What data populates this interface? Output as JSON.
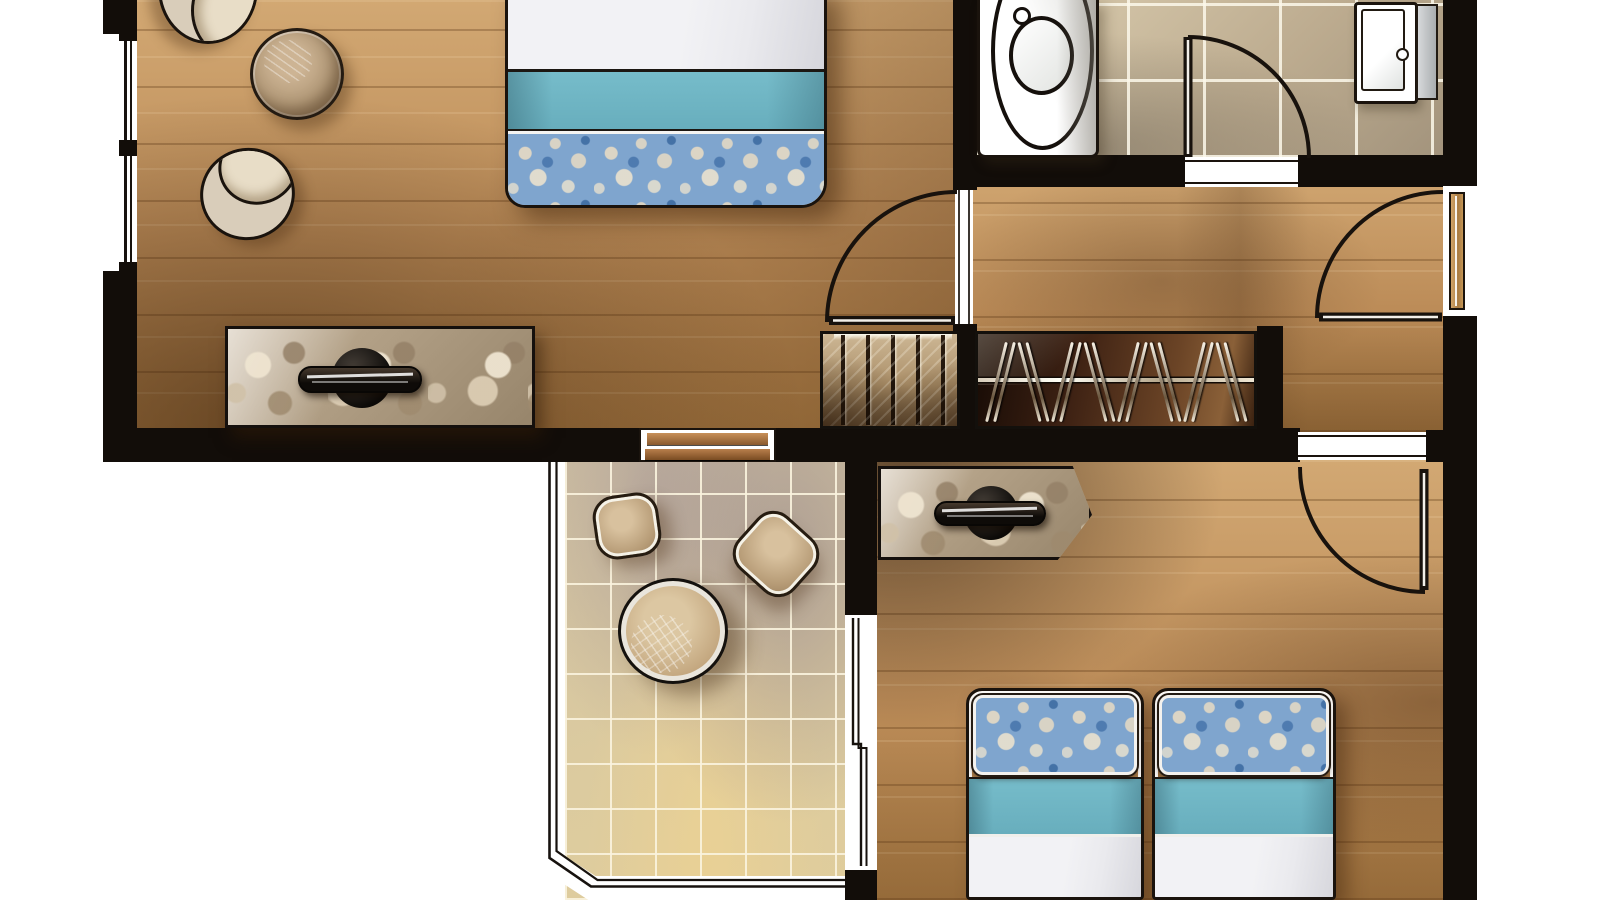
{
  "scene": {
    "label": "Hand-rendered apartment floor plan, top-down view",
    "canvas": {
      "width": 1600,
      "height": 900
    }
  },
  "palette": {
    "paper": "#ffffff",
    "wall": "#120d09",
    "outline": "#1a130d",
    "wood": "#bc8c58",
    "wood-light": "#d2a873",
    "wood-dark": "#7c5428",
    "tile-bath": "#c6b69a",
    "tile-balcony": "#d9c8a4",
    "teal": "#76bcca",
    "floral-blue": "#7fa5ce",
    "floral-cream": "#ded5c2",
    "linen": "#eaeaee",
    "stone": "#b3a189",
    "closet-dark": "#26130a",
    "closet-light": "#8a5f3c",
    "chrome": "#d7d9db"
  },
  "rooms": [
    {
      "id": "bedroom-1",
      "floor": "wood-plank",
      "contents": [
        "double-bed-white-teal-floral",
        "round-pouf",
        "scoop-chair",
        "scoop-chair-partial",
        "stone-top-desk",
        "desk-chair",
        "window-wall-left",
        "french-door-to-balcony"
      ]
    },
    {
      "id": "bathroom",
      "floor": "ceramic-tile",
      "contents": [
        "bathtub",
        "shower-basin",
        "hinged-door"
      ]
    },
    {
      "id": "hallway",
      "floor": "wood-plank",
      "contents": [
        "staircase",
        "open-wardrobe-with-hangers",
        "door-to-bedroom-1",
        "entry-door"
      ]
    },
    {
      "id": "balcony",
      "floor": "stone-tile",
      "contents": [
        "patio-chair",
        "patio-chair",
        "round-patio-table",
        "glass-railing",
        "sliding-window-to-bedroom-2"
      ]
    },
    {
      "id": "bedroom-2",
      "floor": "wood-plank",
      "contents": [
        "stone-top-desk",
        "desk-chair",
        "single-bed",
        "single-bed",
        "hinged-door"
      ]
    }
  ],
  "fixtures": {
    "staircase": {
      "treads": 5
    },
    "wardrobe": {
      "hangers": 8
    },
    "left-window": {
      "panes": 2
    },
    "doors": {
      "hinged": 4,
      "sliding": 1
    }
  }
}
